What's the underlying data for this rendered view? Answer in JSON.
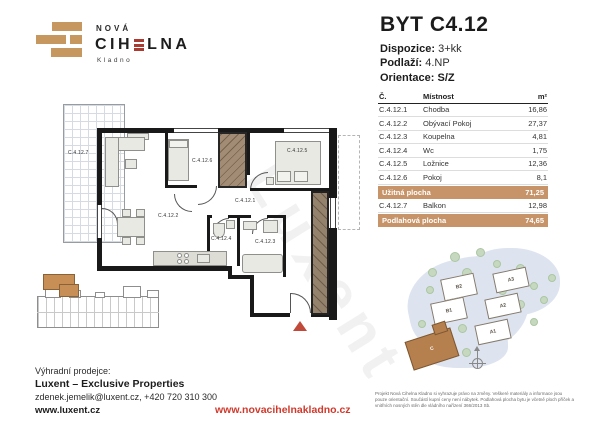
{
  "logo": {
    "line1": "NOVÁ",
    "line2_left": "CIH",
    "line2_right": "LNA",
    "line3": "Kladno"
  },
  "header": {
    "title": "BYT C4.12",
    "specs": [
      {
        "label": "Dispozice:",
        "value": "3+kk"
      },
      {
        "label": "Podlaží:",
        "value": "4.NP"
      },
      {
        "label": "Orientace:",
        "value": "S/Z"
      }
    ]
  },
  "room_table": {
    "headers": {
      "number": "Č.",
      "room": "Místnost",
      "area": "m²"
    },
    "rows": [
      {
        "number": "C.4.12.1",
        "room": "Chodba",
        "area": "16,86"
      },
      {
        "number": "C.4.12.2",
        "room": "Obývací Pokoj",
        "area": "27,37"
      },
      {
        "number": "C.4.12.3",
        "room": "Koupelna",
        "area": "4,81"
      },
      {
        "number": "C.4.12.4",
        "room": "Wc",
        "area": "1,75"
      },
      {
        "number": "C.4.12.5",
        "room": "Ložnice",
        "area": "12,36"
      },
      {
        "number": "C.4.12.6",
        "room": "Pokoj",
        "area": "8,1"
      }
    ],
    "summary_useful": {
      "label": "Užitná plocha",
      "value": "71,25"
    },
    "balcony_row": {
      "number": "C.4.12.7",
      "room": "Balkon",
      "area": "12,98"
    },
    "summary_floor": {
      "label": "Podlahová plocha",
      "value": "74,65"
    }
  },
  "floor_plan": {
    "labels": {
      "balcony": "C.4.12.7",
      "living": "C.4.12.2",
      "room": "C.4.12.6",
      "bedroom": "C.4.12.5",
      "hall": "C.4.12.1",
      "wc": "C.4.12.4",
      "bath": "C.4.12.3"
    },
    "watermark": "Luxent"
  },
  "site_plan": {
    "buildings": [
      "B2",
      "B1",
      "A3",
      "A2",
      "A1"
    ],
    "highlighted_building": "C"
  },
  "footer": {
    "seller_label": "Výhradní prodejce:",
    "seller_name": "Luxent – Exclusive Properties",
    "seller_contact": "zdenek.jemelik@luxent.cz, +420 720 310 300",
    "seller_web": "www.luxent.cz",
    "project_web": "www.novacihelnakladno.cz",
    "disclaimer": "Projekt Nová Cihelna Kladno si vyhrazuje právo na změny. Veškeré materiály a informace jsou pouze orientační. Součástí kupní ceny není nábytek. Podlahová plocha bytu je včetně ploch příček a vnitřních nosných stěn dle vládního nařízení 366/2013 Sb."
  },
  "colors": {
    "brand_tan": "#c6985f",
    "brand_red": "#a93b33",
    "web_red": "#d0392b",
    "table_highlight": "#c69468",
    "highlight_unit": "#c78e55",
    "wall": "#191919"
  }
}
